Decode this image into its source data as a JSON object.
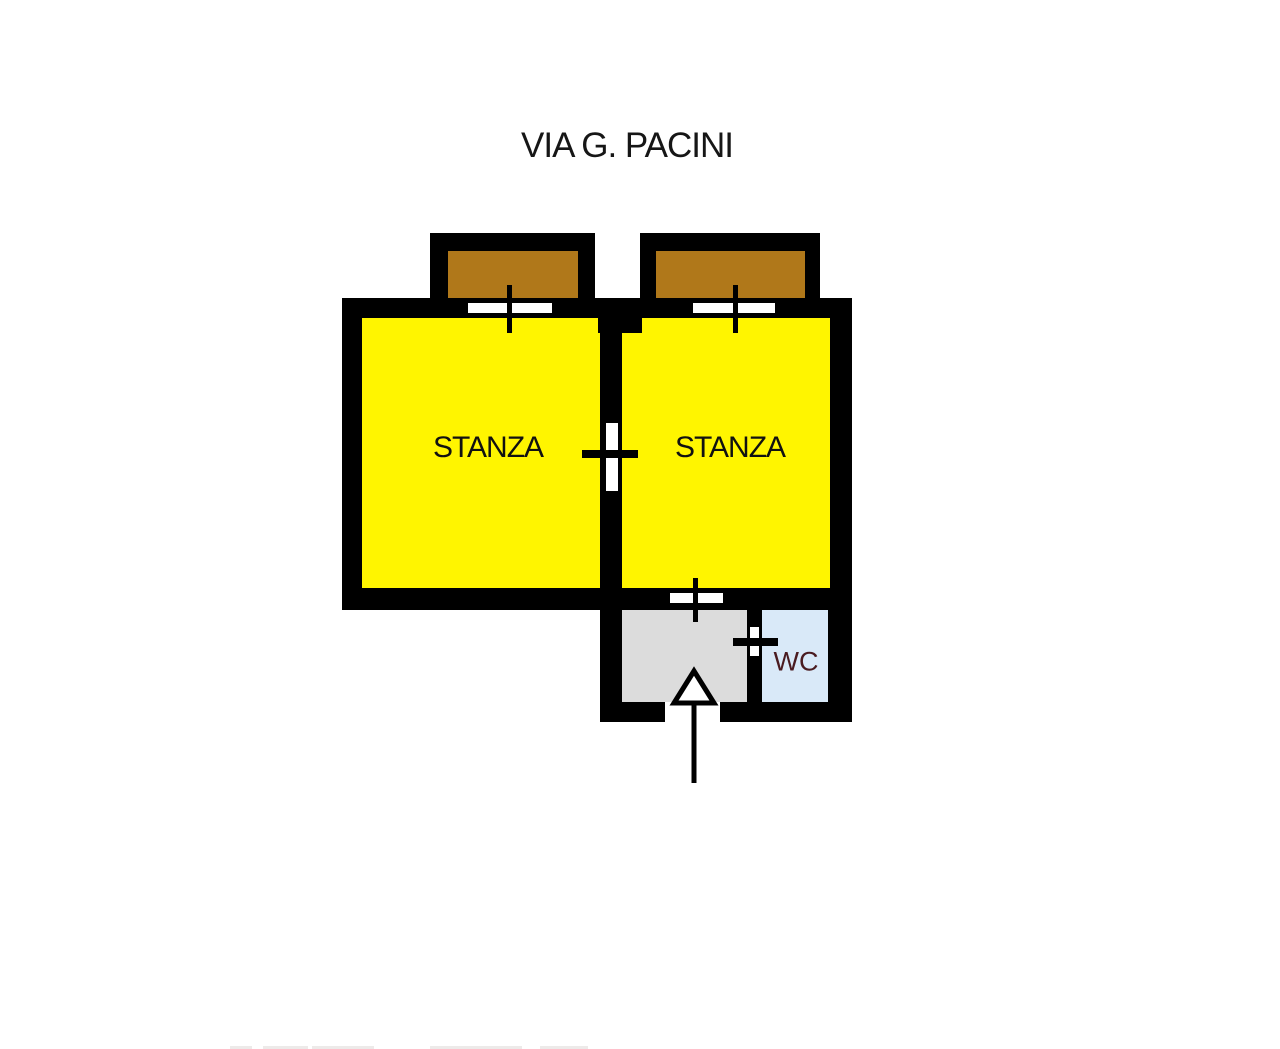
{
  "title": {
    "text": "VIA G. PACINI"
  },
  "rooms": {
    "stanza_left": {
      "label": "STANZA",
      "fill": "#FFF500"
    },
    "stanza_right": {
      "label": "STANZA",
      "fill": "#FFF500"
    },
    "hallway": {
      "fill": "#DCDCDC"
    },
    "wc": {
      "label": "WC",
      "fill": "#D9E9F8",
      "label_color": "#4A1B20"
    }
  },
  "balconies": {
    "fill": "#B0781A"
  },
  "walls": {
    "color": "#000000"
  },
  "background": "#FFFFFF",
  "symbols": {
    "window_count": 2,
    "door_count": 3,
    "entrance_arrow": "up"
  }
}
